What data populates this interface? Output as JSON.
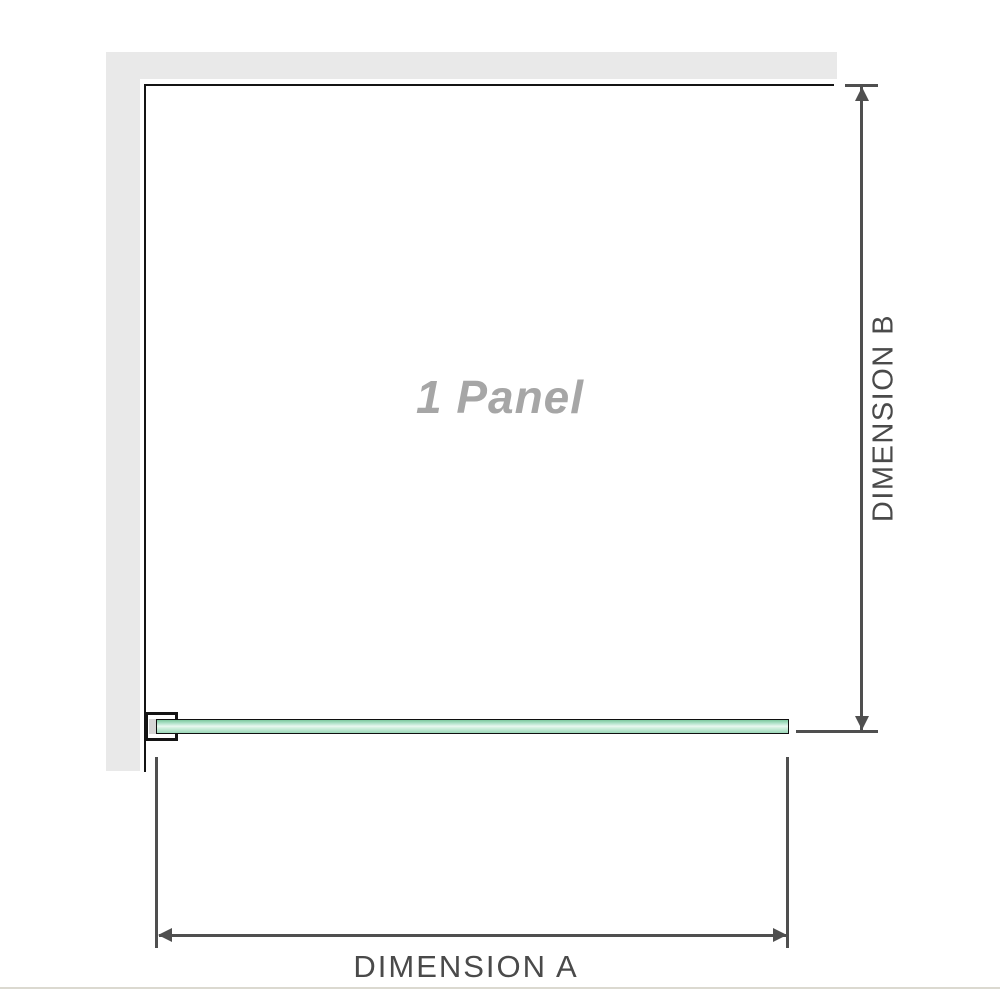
{
  "diagram": {
    "panel_label": "1 Panel",
    "dimension_vertical": {
      "label": "DIMENSION B"
    },
    "dimension_horizontal": {
      "label": "DIMENSION A"
    }
  },
  "colors": {
    "wall": "#e9e9e9",
    "outline": "#141414",
    "dimension_lines": "#4f4f4f",
    "dimension_text": "#4a4a4a",
    "panel_label_text": "#a6a6a6",
    "glass_green": "#9bd8b8",
    "glass_highlight": "#e9f8f0",
    "divider": "#dbd9d0"
  }
}
